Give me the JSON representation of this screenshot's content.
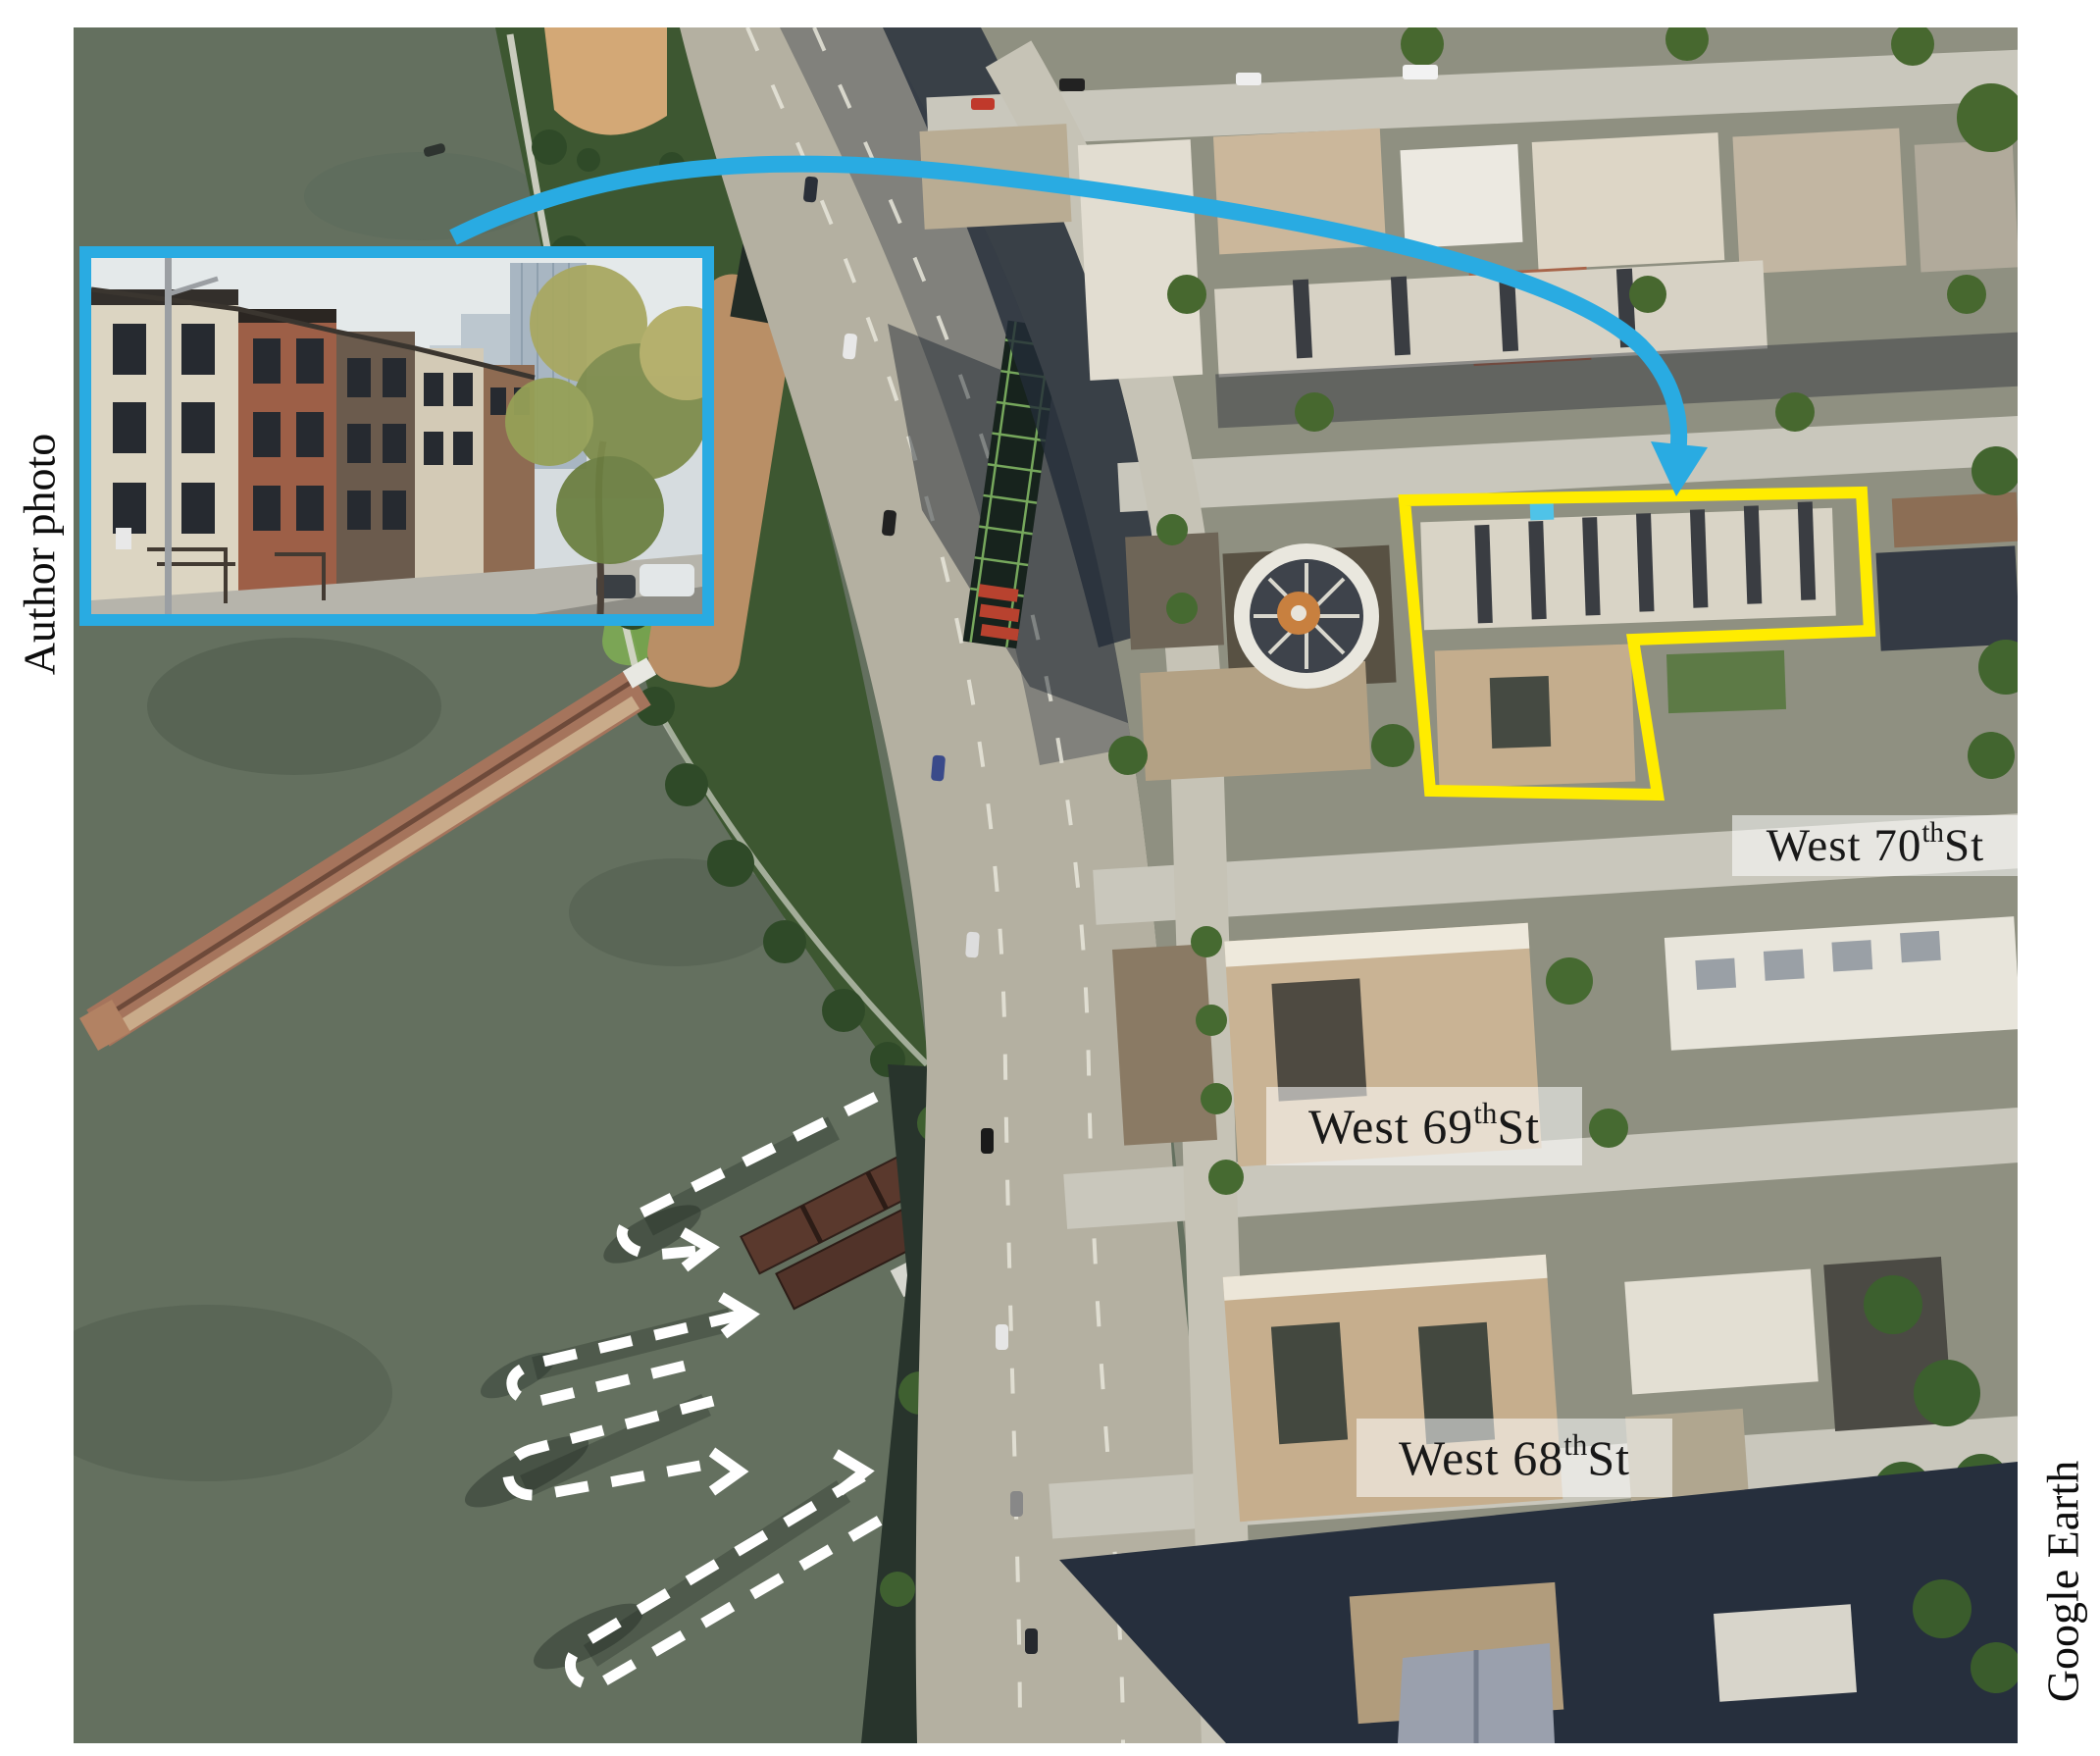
{
  "figure_credits": {
    "photo": "Author photo",
    "map": "Google Earth"
  },
  "street_labels": [
    {
      "prefix": "West 70",
      "sup": "th",
      "suffix": " St"
    },
    {
      "prefix": "West 69",
      "sup": "th",
      "suffix": " St"
    },
    {
      "prefix": "West 68",
      "sup": "th",
      "suffix": " St"
    }
  ],
  "annotation_colors": {
    "highlight_block_outline": "#ffec00",
    "arrow_and_inset_border": "#29abe2",
    "dashed_wreck_outline": "#ffffff",
    "label_text": "#181818",
    "label_background": "rgba(255,255,255,0.55)"
  }
}
